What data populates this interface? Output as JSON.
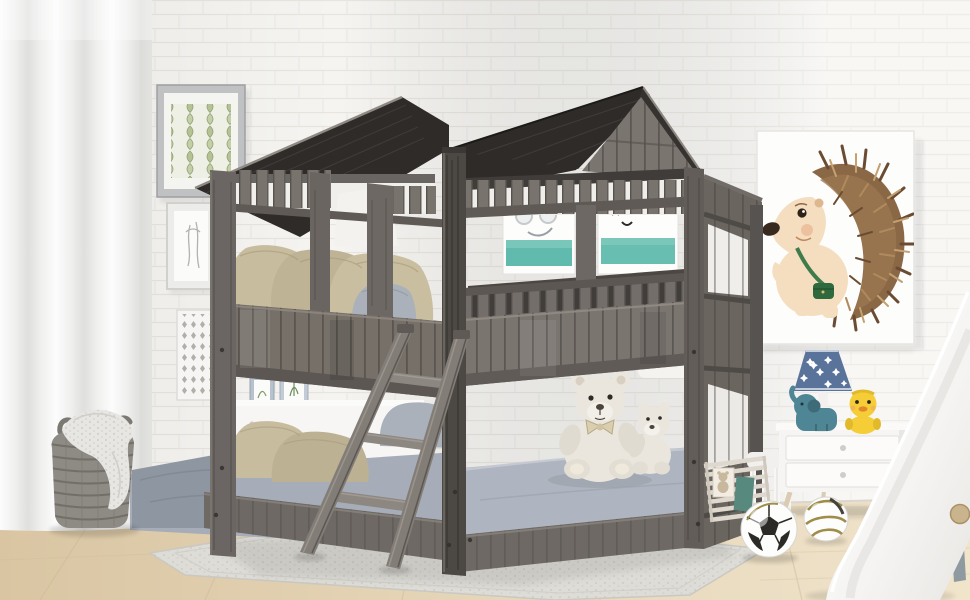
{
  "meta": {
    "type": "product-photo",
    "subject": "kids house-style twin-over-twin bunk bed with two gabled roofs in a decorated children's room",
    "canvas": {
      "width": 970,
      "height": 600
    }
  },
  "scene": {
    "bed": {
      "name": "house-frame bunk bed",
      "finish": "rustic weathered gray wood",
      "roof": "charcoal plank gabled roofs, two peaks",
      "parts": [
        "gabled roofs",
        "clerestory slat rows",
        "window openings",
        "plank guardrails",
        "angled ladder",
        "low platform base"
      ]
    },
    "bedding": {
      "upper_pillows": "three khaki pillows",
      "upper_accent_pillow": "gray-blue pillow at ladder opening",
      "lower_pillows": "two khaki pillows and gray pillows",
      "mattress": "gray fitted mattress",
      "plush_toys": "two cream teddy bears"
    },
    "left_wall": {
      "curtain": "sheer white floor-length curtain",
      "frames": [
        "green trellis print in silver frame",
        "figure sketch in white frame",
        "white lattice panel"
      ]
    },
    "behind_bed": [
      "white dresser with two small picture frames and wood easel",
      "white poster with teal band and yellow goggles doodle",
      "white poster with teal band and black letter doodles"
    ],
    "right_wall": {
      "poster": "watercolor hedgehog nursery print in white frame"
    },
    "right_side": [
      "white two-drawer nightstand",
      "navy star lamp",
      "teal elephant toy",
      "yellow duck toy",
      "white kids slide with wood button",
      "two soccer balls",
      "slatted rack with bear card and teal card",
      "white chair"
    ],
    "floor_items": [
      "light oak wood floor",
      "light gray woven rug",
      "gray wicker basket with knit blanket"
    ]
  },
  "colors": {
    "wall": "#f5f4f1",
    "brick_line": "#e8e5e0",
    "floor_light": "#f0e4cb",
    "floor_dark": "#d9c5a2",
    "rug": "#dddcd6",
    "curtain": "#f3f3f2",
    "roof": "#2e2b29",
    "roof_edge": "#8e8983",
    "wood": "#77716b",
    "wood_dark": "#5f5a56",
    "wood_gap": "#3d3935",
    "side_wood": "#6b6560",
    "pillow_khaki": "#c7bc9e",
    "pillow_gray": "#aab1ba",
    "mattress": "#a6adb8",
    "sheet": "#8e96a1",
    "bear": "#eae6de",
    "poster_teal": "#4fb3a4",
    "goggles_yellow": "#ddc040",
    "hedgehog_spike": "#8a6745",
    "hedgehog_body": "#f4debf",
    "strap_green": "#3f7b4b",
    "lamp_navy": "#5a739b",
    "elephant": "#4e8695",
    "duck": "#f4cd37",
    "nightstand": "#fbfaf9",
    "leg_wood": "#d9ccb2",
    "basket": "#8e8a84",
    "blanket": "#e7e6e3",
    "ball_gold": "#a08d4a",
    "slide": "#fafaf9",
    "knob": "#c9b48d",
    "frame_silver": "#c0c1c3",
    "art_green": "#a9b78c"
  }
}
